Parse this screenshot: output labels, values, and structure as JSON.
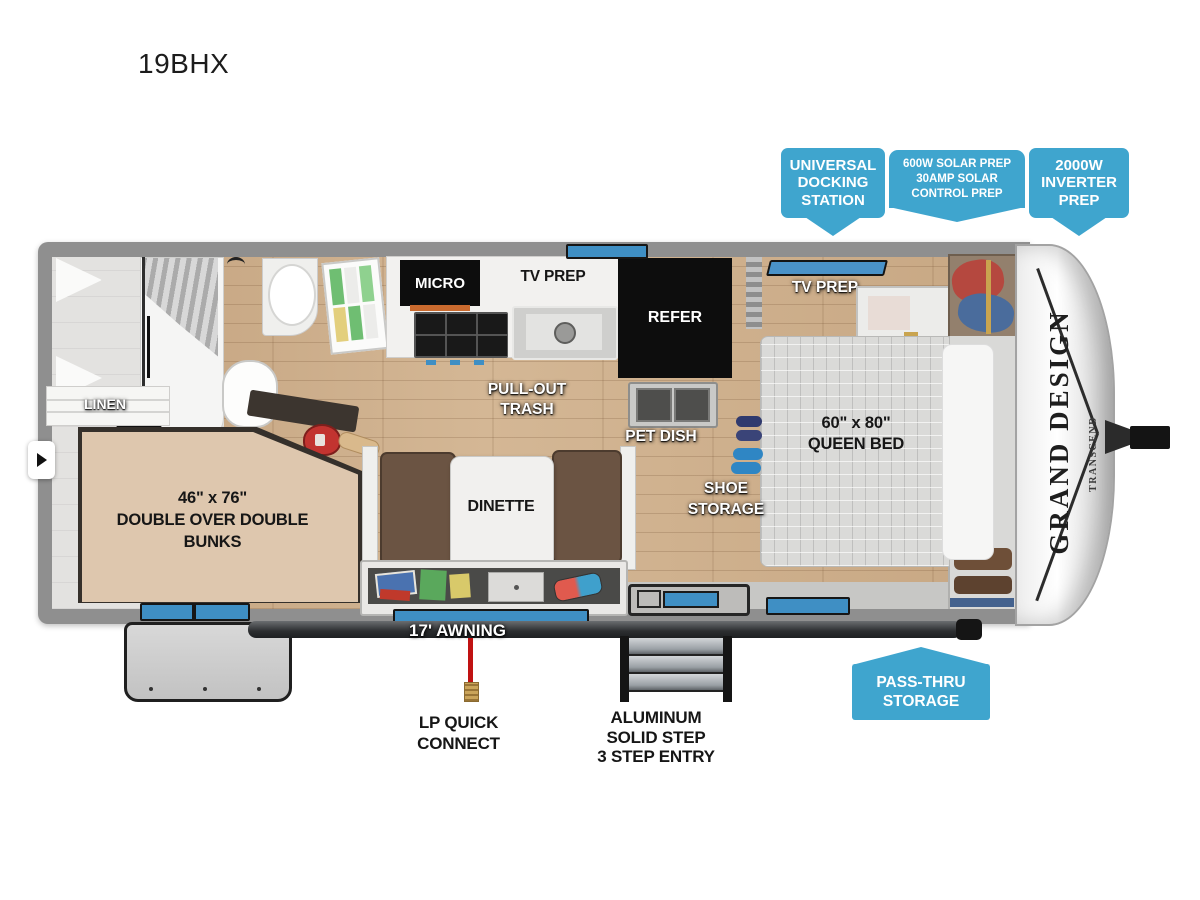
{
  "page": {
    "model": "19BHX"
  },
  "theme": {
    "callout_blue": "#3FA5CE",
    "wall_gray": "#8f8f8f",
    "wood_floor": "#c9aa87",
    "window_blue": "#3f8fc4",
    "awning_dark": "#2c2e30",
    "accent_red": "#c01212"
  },
  "feature_callouts": {
    "universal_docking": {
      "lines": [
        "UNIVERSAL",
        "DOCKING",
        "STATION"
      ]
    },
    "solar_prep": {
      "lines": [
        "600W SOLAR PREP",
        "30AMP SOLAR",
        "CONTROL PREP"
      ]
    },
    "inverter_prep": {
      "lines": [
        "2000W",
        "INVERTER",
        "PREP"
      ]
    },
    "pass_thru": {
      "lines": [
        "PASS-THRU",
        "STORAGE"
      ]
    }
  },
  "floorplan": {
    "labels": {
      "linen": "LINEN",
      "micro": "MICRO",
      "kitchen_tv_prep": "TV PREP",
      "refer": "REFER",
      "pull_out_trash": {
        "lines": [
          "PULL-OUT",
          "TRASH"
        ]
      },
      "pet_dish": "PET DISH",
      "bedroom_tv_prep": "TV PREP",
      "queen_bed": {
        "lines": [
          "60\" x 80\"",
          "QUEEN BED"
        ]
      },
      "shoe_storage": {
        "lines": [
          "SHOE",
          "STORAGE"
        ]
      },
      "bunks": {
        "lines": [
          "46\" x 76\"",
          "DOUBLE OVER DOUBLE",
          "BUNKS"
        ]
      },
      "dinette": "DINETTE"
    },
    "exterior": {
      "awning": "17' AWNING",
      "lp_quick_connect": {
        "lines": [
          "LP QUICK",
          "CONNECT"
        ]
      },
      "entry_steps": {
        "lines": [
          "ALUMINUM",
          "SOLID STEP",
          "3 STEP ENTRY"
        ]
      }
    },
    "branding": {
      "brand": "GRAND DESIGN",
      "series": "TRANSCEND"
    }
  }
}
